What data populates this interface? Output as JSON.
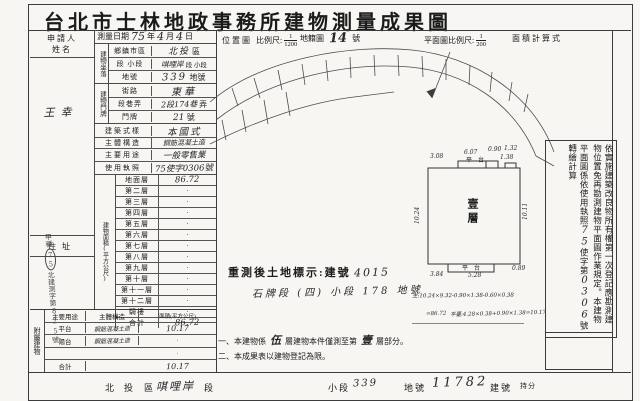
{
  "title": "台北市士林地政事務所建物測量成果圖",
  "header": {
    "location_map": "位置圖",
    "scale_label": "比例尺:",
    "scale_num": "1",
    "scale_den": "1200",
    "cadastral": "地籍圖",
    "sheet_no": "14",
    "sheet_suffix": "號",
    "plan_scale_label": "平面圖比例尺:",
    "plan_num": "1",
    "plan_den": "200",
    "area_calc": "面積計算式"
  },
  "applicant": {
    "name_label": "申請人姓名",
    "name": "王幸",
    "addr_label": "住址"
  },
  "survey": {
    "label": "測量日期",
    "year": "75",
    "y_unit": "年",
    "month": "4",
    "m_unit": "月",
    "day": "4",
    "d_unit": "日"
  },
  "situs": {
    "group": "建物坐落",
    "district_label": "鄉鎮市區",
    "district": "北投",
    "district_suffix": "區",
    "section_label": "段 小段",
    "section": "唭哩岸",
    "section_suffix": "段 小段",
    "lot_label": "地號",
    "lot": "339",
    "lot_suffix": "地號"
  },
  "doorplate": {
    "group": "建物門牌",
    "street_label": "街路",
    "street": "東華",
    "lane_label": "段巷弄",
    "lane": "2段174巷",
    "lane_suffix": "弄",
    "no_label": "門牌",
    "no": "21",
    "no_suffix": "號"
  },
  "building": {
    "style_label": "建築式樣",
    "style": "本國式",
    "structure_label": "主體構造",
    "structure": "鋼筋混凝土造",
    "use_label": "主要用途",
    "use": "一般零售業",
    "permit_label": "使用執照",
    "permit": "75使字0306號"
  },
  "floor_area": {
    "group": "建物面積(平方公尺)",
    "rows": [
      {
        "label": "地面層",
        "value": "86.72"
      },
      {
        "label": "第二層",
        "value": "·"
      },
      {
        "label": "第三層",
        "value": "·"
      },
      {
        "label": "第四層",
        "value": "·"
      },
      {
        "label": "第五層",
        "value": "·"
      },
      {
        "label": "第六層",
        "value": "·"
      },
      {
        "label": "第七層",
        "value": "·"
      },
      {
        "label": "第八層",
        "value": "·"
      },
      {
        "label": "第九層",
        "value": "·"
      },
      {
        "label": "第十層",
        "value": "·"
      },
      {
        "label": "第十一層",
        "value": "·"
      },
      {
        "label": "第十二層",
        "value": "·"
      },
      {
        "label": "騎樓",
        "value": "·"
      },
      {
        "label": "合計",
        "value": "86.72"
      }
    ]
  },
  "annex": {
    "group": "附屬建物",
    "col_use": "主要用途",
    "col_structure": "主體構造",
    "col_area": "面積(平方公尺)",
    "rows": [
      {
        "use": "平台",
        "structure": "鋼筋混凝土造",
        "area": "10.17"
      },
      {
        "use": "陽台",
        "structure": "鋼筋混凝土造",
        "area": "·"
      },
      {
        "use": "",
        "structure": "",
        "area": "·"
      },
      {
        "use": "合計",
        "structure": "",
        "area": "10.17"
      }
    ]
  },
  "stamp": {
    "prefix": "甲種",
    "circled": "75",
    "body": "北建測字第",
    "number": "825",
    "suffix": "號"
  },
  "resurvey": {
    "heading": "重測後土地標示:建號",
    "building_no": "4015",
    "land": "石牌段 (四) 小段 178 地號"
  },
  "calc": {
    "line1": "主:10.24×9.32-0.90×1.38-0.60×0.38",
    "line2": "=86.72",
    "line3": "平臺:4.28×0.38+0.90×1.38=10.17"
  },
  "notes": {
    "n1_pre": "一、本建物係",
    "n1_floors": "伍",
    "n1_mid": "層建物本件僅測至第",
    "n1_floor": "壹",
    "n1_post": "層部分。",
    "n2": "二、本成果表以建物登記為限。"
  },
  "plan": {
    "floor_label": "壹層",
    "platform_top": "平台",
    "platform_bottom": "平台",
    "dims": {
      "top1": "3.08",
      "top2": "6.07",
      "top3": "0.90",
      "top4": "1.32",
      "top5": "1.38",
      "left": "10.24",
      "right": "10.11",
      "bottom1": "3.84",
      "bottom2": "5.28",
      "bottom3": "0.89"
    }
  },
  "side_note": {
    "col1": "依實施建築改良物所有權第一次登記應勘測建",
    "col2": "物位置免再勘測建物平面圖作業規定。本建物",
    "col3_pre": "平面圖係依使用執照",
    "col3_no1": "75",
    "col3_mid": "使字第",
    "col3_no2": "0306",
    "col3_post": "號轉繪計算"
  },
  "footer": {
    "district": "北投",
    "district_label": "區",
    "section": "唭哩岸",
    "section_label": "段",
    "subsection_label": "小段",
    "lot": "339",
    "lot_label": "地號",
    "building_no": "11782",
    "building_no_label": "建號",
    "share_label": "持分"
  }
}
